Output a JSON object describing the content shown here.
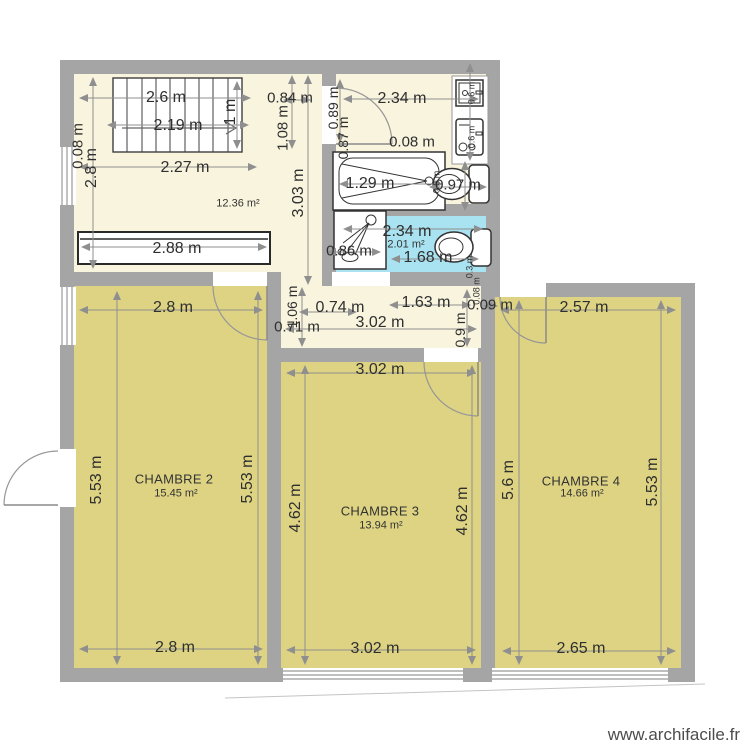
{
  "watermark": "www.archifacile.fr",
  "colors": {
    "wall": "#a5a5a5",
    "floor_hall": "#f8f4de",
    "floor_bedroom": "#ddd383",
    "floor_bath": "#a9e3f2",
    "dimension_text": "#2f2f2f",
    "watermark_text": "#4c4c4c"
  },
  "rooms": {
    "hall_area": "12.36 m²",
    "bath_area": "2.01 m²",
    "ch2_name": "CHAMBRE 2",
    "ch2_area": "15.45 m²",
    "ch3_name": "CHAMBRE 3",
    "ch3_area": "13.94 m²",
    "ch4_name": "CHAMBRE 4",
    "ch4_area": "14.66 m²"
  },
  "dims": {
    "stair_w": "2.6 m",
    "stair_run": "2.19 m",
    "stair_h": "1 m",
    "hall_w": "2.27 m",
    "wall_t": "0.08 m",
    "hall_h": "2.8 m",
    "wardrobe": "2.88 m",
    "entry_w": "0.84 m",
    "entry_h": "1.08 m",
    "hall_v": "3.03 m",
    "bath_w": "2.34 m",
    "bathdoor1": "0.89 m",
    "bathdoor2": "0.87 m",
    "gap": "0.08 m",
    "tub": "1.29 m",
    "wc": "0.97 m",
    "washer": "0.6 m",
    "dryer": "0.6 m",
    "wcside": "0.6 m",
    "blue_w": "2.34 m",
    "blue_inner": "1.68 m",
    "shower": "0.86 m",
    "cistern": "0.3 m",
    "corr1": "0.74 m",
    "corr2": "1.63 m",
    "corr3": "0.09 m",
    "corr_w": "3.02 m",
    "corr4": "0.71 m",
    "corr_v1": "1.06 m",
    "corr_v2": "0.9 m",
    "corr_t": "0.08 m",
    "ch2_top": "2.8 m",
    "ch2_bottom": "2.8 m",
    "ch2_left": "5.53 m",
    "ch2_right": "5.53 m",
    "ch3_top": "3.02 m",
    "ch3_bottom": "3.02 m",
    "ch3_left": "4.62 m",
    "ch3_right": "4.62 m",
    "ch4_top": "2.57 m",
    "ch4_bottom": "2.65 m",
    "ch4_left": "5.6 m",
    "ch4_right": "5.53 m"
  }
}
